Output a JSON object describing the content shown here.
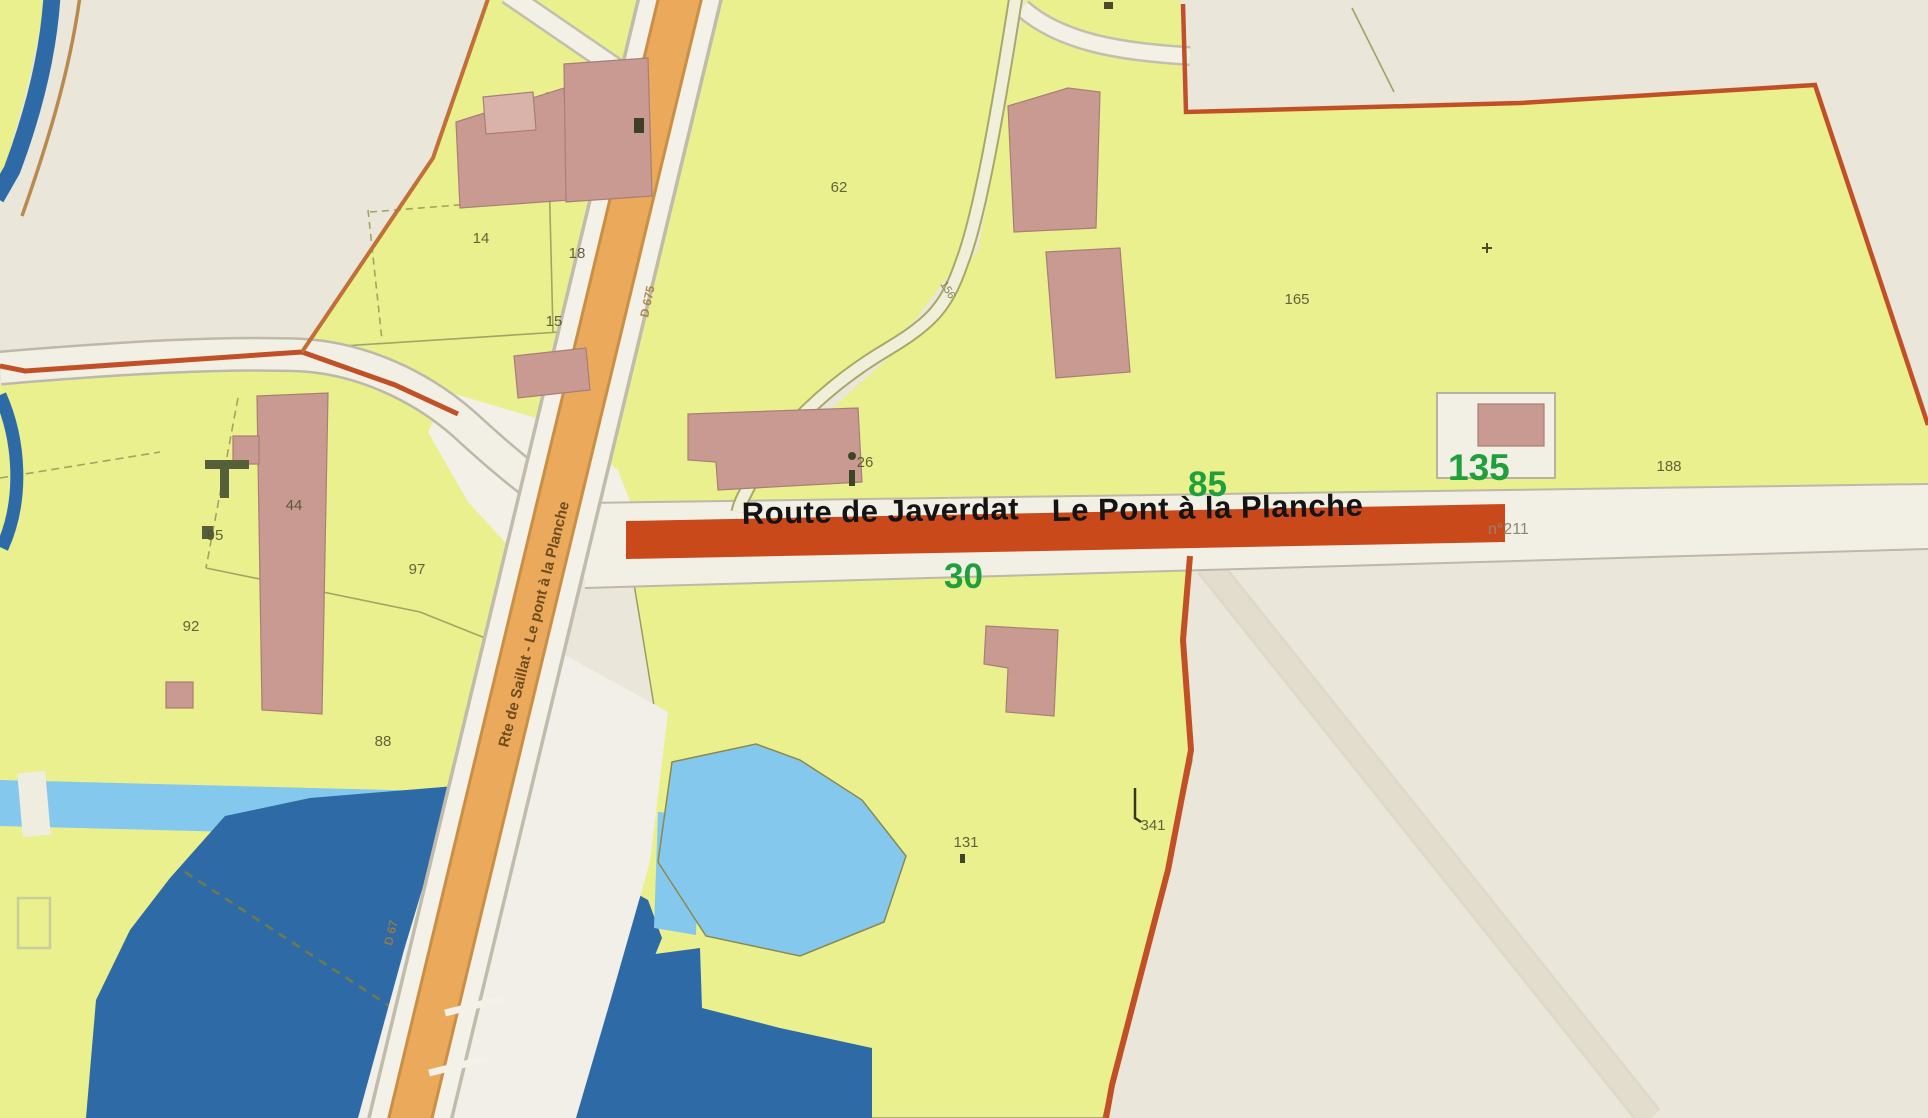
{
  "map": {
    "main_road_labels": {
      "west": "Route de Javerdat",
      "east": "Le Pont à la Planche"
    },
    "address_numbers": {
      "n30": "30",
      "n85": "85",
      "n135": "135"
    },
    "road_refs": {
      "east_ref": "n°211",
      "vertical_road_name": "Rte de Saillat - Le pont à la Planche",
      "shield_upper": "D 675",
      "shield_lower": "D 67",
      "path_ref": "156"
    },
    "parcel_numbers": {
      "p14": "14",
      "p18": "18",
      "p15": "15",
      "p62": "62",
      "p165": "165",
      "p44": "44",
      "p95": "95",
      "p97": "97",
      "p92": "92",
      "p88": "88",
      "p131": "131",
      "p341": "341",
      "p188": "188",
      "p26": "26"
    },
    "colors": {
      "background": "#EAE6D9",
      "parcel_yellow": "#E9F08D",
      "building_pink": "#C99A92",
      "road_orange": "#EAA95B",
      "highlight_red": "#C9491B",
      "water_dark": "#2E6BA6",
      "water_light": "#85C8ED",
      "number_green": "#1FA03C"
    }
  }
}
